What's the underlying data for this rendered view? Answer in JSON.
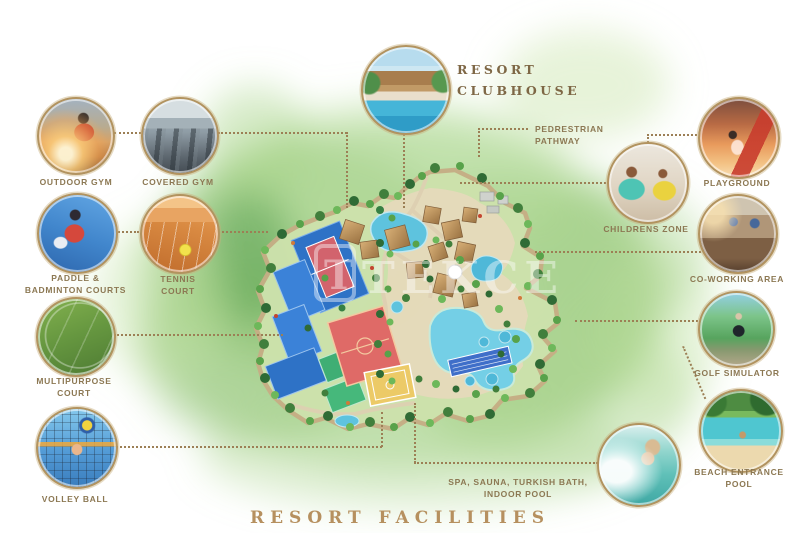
{
  "title": "RESORT FACILITIES",
  "watermark": "TEKCE",
  "callouts": {
    "outdoor_gym": "OUTDOOR GYM",
    "covered_gym": "COVERED GYM",
    "resort_clubhouse": "RESORT\nCLUBHOUSE",
    "paddle_badminton": "PADDLE &\nBADMINTON COURTS",
    "tennis_court": "TENNIS\nCOURT",
    "multipurpose_court": "MULTIPURPOSE\nCOURT",
    "volley_ball": "VOLLEY BALL",
    "playground": "PLAYGROUND",
    "childrens_zone": "CHILDRENS ZONE",
    "co_working_area": "CO-WORKING AREA",
    "golf_simulator": "GOLF SIMULATOR",
    "beach_entrance_pool": "BEACH ENTRANCE\nPOOL",
    "spa": "SPA, SAUNA, TURKISH BATH,\nINDOOR POOL",
    "pedestrian_pathway": "PEDRESTRIAN\nPATHWAY"
  },
  "colors": {
    "accent_gold": "#b6905f",
    "label_brown": "#8c7853",
    "dotted_line": "#9c7f55",
    "pool_cyan": "#6fcbe4",
    "court_blue": "#2e72c6",
    "court_red": "#df6a67",
    "court_green": "#3fae74",
    "court_yellow": "#ecca67"
  }
}
